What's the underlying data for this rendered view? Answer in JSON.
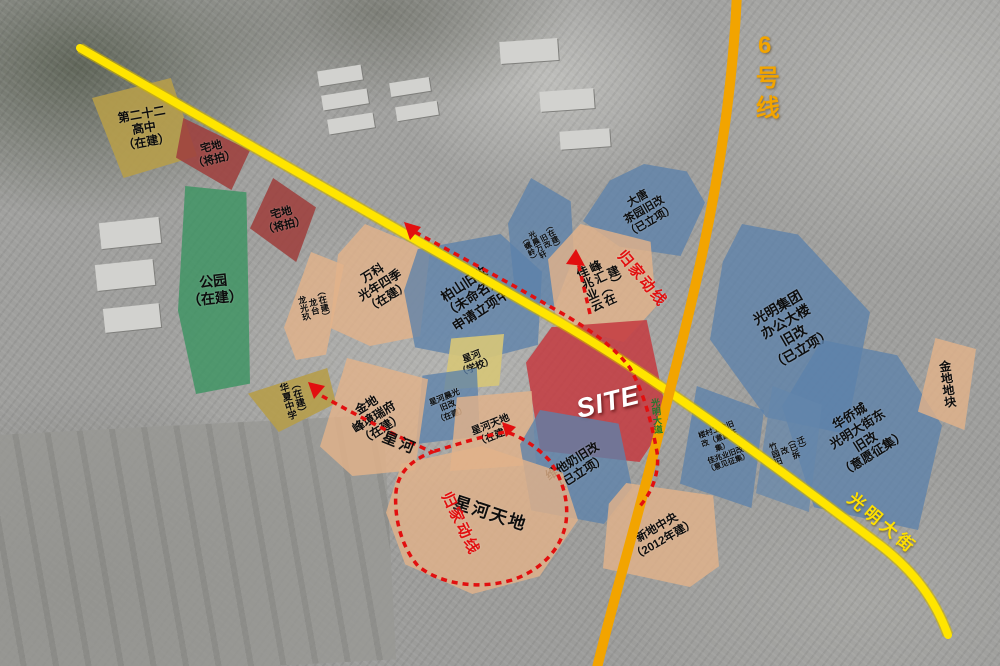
{
  "map_type": "urban-renewal-planning-map",
  "site": {
    "label": "SITE"
  },
  "roads": {
    "line6": "6号线",
    "guangming_street": "光明大街",
    "guangming_avenue": "光明大道"
  },
  "routes": {
    "homeline_label": "归家动线"
  },
  "zones": [
    {
      "id": "school22",
      "label": "第二十二\n高中\n（在建）"
    },
    {
      "id": "zhaidi-1",
      "label": "宅地\n（将拍）"
    },
    {
      "id": "zhaidi-2",
      "label": "宅地\n（将拍）"
    },
    {
      "id": "park",
      "label": "公园\n（在建）"
    },
    {
      "id": "vanke-guangnian",
      "label": "万科\n光年四季\n（在建）"
    },
    {
      "id": "longguang-jiulongtai",
      "label": "龙光玖\n龙台\n（在建）"
    },
    {
      "id": "baishan-renewal",
      "label": "柏山旧改\n（未命名）\n申请立项中"
    },
    {
      "id": "luoling-renewal",
      "label": "（螺岭）\n光晨万轩\n旧改\n（在建）"
    },
    {
      "id": "datang-chayuan",
      "label": "大唐\n茶园旧改\n（已立项）"
    },
    {
      "id": "kaisa-yunfenghui",
      "label": "佳兆业云\n峰汇（在\n建）"
    },
    {
      "id": "guangming-group",
      "label": "光明集团\n办公大楼\n旧改\n（已立项）"
    },
    {
      "id": "oct-street-east",
      "label": "华侨城\n光明大街东\n旧改\n（意愿征集）"
    },
    {
      "id": "jindi-block",
      "label": "金地地块"
    },
    {
      "id": "zhuyuan-renewal",
      "label": "竹园旧\n改\n（已拆\n迁）"
    },
    {
      "id": "loucun-renewal",
      "label": "楼村工会旧\n改（意愿征\n集）\n佳兆业旧改\n（意见征集）"
    },
    {
      "id": "site-zone",
      "label": "SITE"
    },
    {
      "id": "xinghe-school",
      "label": "星河\n（学校）"
    },
    {
      "id": "xinghe-chenguang",
      "label": "星河晨光\n旧改\n（在建）"
    },
    {
      "id": "xinghe-tiandi-small",
      "label": "星河天地\n（在建）"
    },
    {
      "id": "vitasoy-renewal",
      "label": "维他奶旧改\n（已立项）"
    },
    {
      "id": "jindi-fengjing",
      "label": "金地\n峰境瑞府\n（在建）"
    },
    {
      "id": "huaxia-school",
      "label": "华夏中学\n（在建）"
    },
    {
      "id": "xinghe-tiandi-big",
      "label": "星河天地"
    },
    {
      "id": "xindi-central",
      "label": "新地中央\n（2012年建）"
    },
    {
      "id": "xinghe-area",
      "label": "星河"
    }
  ],
  "colors": {
    "blue_zone": "#5c82aa",
    "tan_zone": "#e2b28a",
    "red_zone": "#c43a40",
    "maroon_zone": "#9e403e",
    "green_zone": "#3a9460",
    "yellow_zone": "#b69d4a",
    "road_yellow": "#ffe500",
    "metro_orange": "#f2a400",
    "route_red": "#e20f0f"
  }
}
